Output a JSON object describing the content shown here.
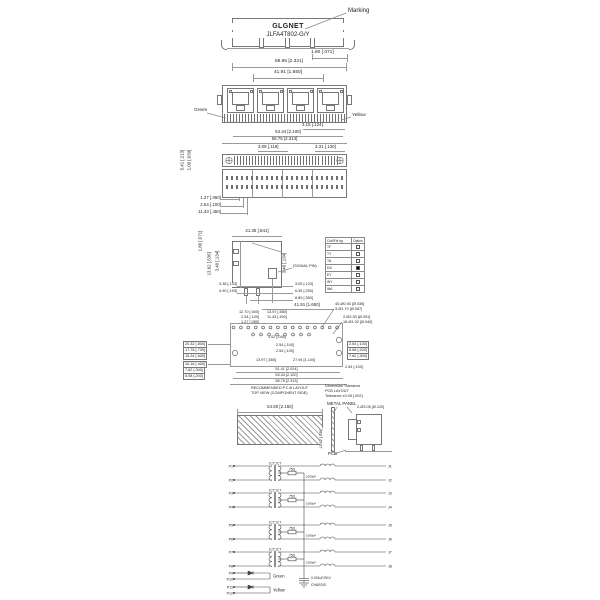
{
  "top_view": {
    "brand": "GLGNET",
    "part": "JLFA4T802-G/Y",
    "marking": "Marking",
    "dim_edge": "1.80 [.071]",
    "dim_width": "58.95 [2.321]"
  },
  "front_view": {
    "dim_top": "41.91 [1.650]",
    "led_left": "Green",
    "led_right": "Yellow",
    "dim_led": "3.15 [.124]",
    "dim_inner": "53.34 [2.100]",
    "dim_outer": "58.75 [2.313]"
  },
  "bottom_view": {
    "dim_a": "3.08 [.118]",
    "dim_b": "3.31 [.130]",
    "dim_height": "5.41 [.213]",
    "dim_step": "1.00 [.039]",
    "pitch_dims": [
      "1.27 [.050]",
      "2.54 [.100]",
      "11.43 [.450]"
    ]
  },
  "side_view": {
    "dim_edge": "1.80 [.071]",
    "dim_top": "21.35 [.841]",
    "dim_h1": "13.62 [.536]",
    "dim_h2": "3.40 [.134]",
    "dim_h3": "3.40 [.134]",
    "signal_pin": "(SIGNAL PIN)",
    "dims_bl": [
      "3.38 [.133]",
      "4.90 [.193]"
    ],
    "dims_br": [
      "3.05 [.120]",
      "6.35 [.250]",
      "8.89 [.350]"
    ]
  },
  "option_table": {
    "header": [
      "Coil/Fix'ng",
      "Option"
    ],
    "rows": [
      {
        "label": "TF",
        "box_class": "chk"
      },
      {
        "label": "TY",
        "box_class": "chk"
      },
      {
        "label": "TA",
        "box_class": "chk"
      },
      {
        "label": "DA",
        "box_class": "chk filled"
      },
      {
        "label": "EY",
        "box_class": "chk"
      },
      {
        "label": "WY",
        "box_class": "chk"
      },
      {
        "label": "WA",
        "box_class": "chk"
      }
    ]
  },
  "pcb": {
    "dim_top": "41.91 [1.650]",
    "left_stack": [
      "12.70 [.500]",
      "2.54 [.100]",
      "1.27 [.050]"
    ],
    "mid_stack": [
      "13.97 [.550]",
      "11.43 [.450]"
    ],
    "callout_a": [
      "40-Ø0.90 [Ø.035]",
      "3-Ø1.70 [Ø.067]"
    ],
    "callout_b": [
      "2-Ø2.30 [Ø.091]",
      "16-Ø1.02 [Ø.040]"
    ],
    "mid_dims": [
      "1.02 [.040]",
      "2.54 [.100]",
      "2.54 [.100]",
      "13.97 [.550]",
      "27.94 [1.100]"
    ],
    "left_boxes": [
      "20.32 [.800]",
      "17.78 [.700]",
      "15.24 [.600]",
      "10.16 [.400]",
      "7.62 [.300]",
      "5.08 [.200]"
    ],
    "right_boxes": [
      "2.54 [.100]",
      "5.08 [.200]",
      "7.62 [.300]"
    ],
    "dim_rb": "2.54 [.100]",
    "bottom_dims": [
      "51.41 [2.024]",
      "53.34 [2.100]",
      "58.75 [2.313]"
    ],
    "caption": [
      "RECOMMENDED P.C.B LAYOUT",
      "TOP VIEW (COMPONENT SIDE)"
    ],
    "tolerance": [
      "Dimension Tolerance",
      "PCB LAYOUT",
      "Tolerance ±0.05 [.002]"
    ]
  },
  "panel": {
    "label_panel": "METAL PANEL",
    "label_pcb": "PCB",
    "dim_width": "54.60 [2.150]",
    "dim_height": "13.62 [.536]",
    "callout": "2-Ø3.05 [Ø.120]"
  },
  "schematic": {
    "ratio": "1CT:1CT",
    "resistor": "75Ω",
    "cap": "0.001uF/2KV",
    "cap_note": "1000pF",
    "chassis": "CHASSIS",
    "green": "Green",
    "yellow": "Yellow",
    "left_pins": [
      "P1",
      "P2",
      "P3",
      "P4",
      "P5",
      "P6",
      "P7",
      "P8"
    ],
    "right_pins": [
      "J1",
      "J2",
      "J3",
      "J4",
      "J5",
      "J6",
      "J7",
      "J8"
    ],
    "led_pins": [
      "P9",
      "P10",
      "P11",
      "P12"
    ]
  }
}
